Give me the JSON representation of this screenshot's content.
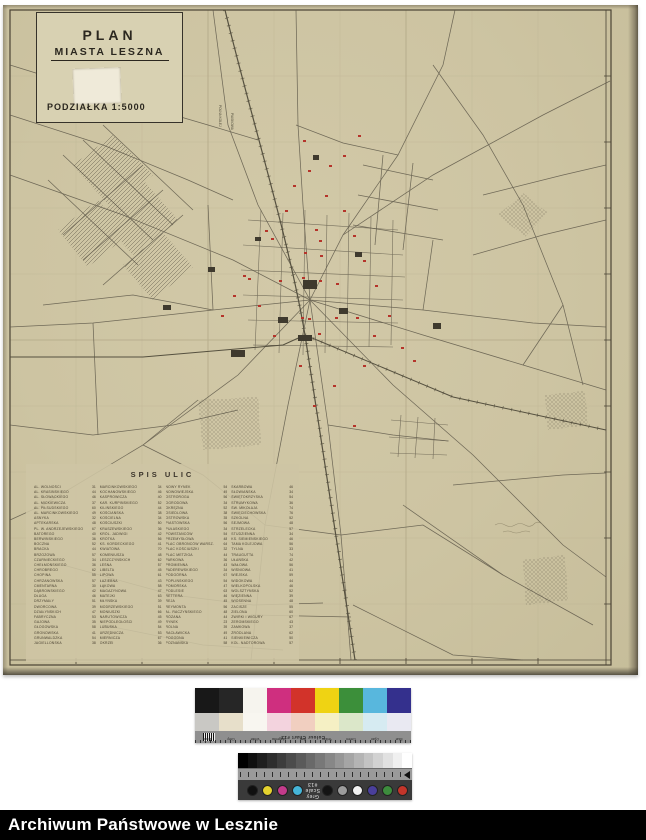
{
  "map_sheet": {
    "title_block": {
      "line1": "PLAN",
      "line2": "MIASTA LESZNA",
      "scale_label": "PODZIAŁKA 1:5000"
    },
    "street_index": {
      "title": "SPIS ULIC",
      "columns": [
        [
          [
            "AL. WOLNOŚCI",
            "31"
          ],
          [
            "AL. KRASIŃSKIEGO",
            "44"
          ],
          [
            "AL. SŁOWACKIEGO",
            "46"
          ],
          [
            "AL. MICKIEWICZA",
            "37"
          ],
          [
            "AL. PIŁSUDSKIEGO",
            "60"
          ],
          [
            "AL. MARCINKOWSKIEGO",
            "49"
          ],
          [
            "ASNYKA",
            "32"
          ],
          [
            "APTEKARSKA",
            "48"
          ],
          [
            "PL. W. ANDRZEJEWSKIEGO",
            "67"
          ],
          [
            "BATOREGO",
            "40"
          ],
          [
            "BERWIŃSKIEGO",
            "36"
          ],
          [
            "BOCZNA",
            "52"
          ],
          [
            "BRACKA",
            "44"
          ],
          [
            "BRZOZOWA",
            "57"
          ],
          [
            "CZARNIECKIEGO",
            "34"
          ],
          [
            "CHEŁMOŃSKIEGO",
            "36"
          ],
          [
            "CHROBREGO",
            "62"
          ],
          [
            "CHOPINA",
            "55"
          ],
          [
            "CHRZANOWSKA",
            "57"
          ],
          [
            "CMENTARNA",
            "30"
          ],
          [
            "DĄBROWSKIEGO",
            "42"
          ],
          [
            "DŁUGA",
            "46"
          ],
          [
            "DRZYMAŁY",
            "51"
          ],
          [
            "DWORCOWA",
            "39"
          ],
          [
            "DZIAŁYŃSKICH",
            "47"
          ],
          [
            "FABRYCZNA",
            "53"
          ],
          [
            "GAJOWA",
            "35"
          ],
          [
            "GŁOGOWSKA",
            "58"
          ],
          [
            "GRONOWSKA",
            "41"
          ],
          [
            "GRUNWALDZKA",
            "54"
          ],
          [
            "JAGIELLOŃSKA",
            "38"
          ]
        ],
        [
          [
            "MARCINKOWSKIEGO",
            "34"
          ],
          [
            "KOCHANOWSKIEGO",
            "46"
          ],
          [
            "KASPROWICZA",
            "40"
          ],
          [
            "KAR. KURPIŃSKIEGO",
            "52"
          ],
          [
            "KILIŃSKIEGO",
            "44"
          ],
          [
            "KOŚCIAŃSKA",
            "38"
          ],
          [
            "KOŚCIELNA",
            "34"
          ],
          [
            "KOŚCIUSZKI",
            "50"
          ],
          [
            "KRASZEWSKIEGO",
            "36"
          ],
          [
            "KRÓL. JADWIGI",
            "42"
          ],
          [
            "KRÓTKA",
            "56"
          ],
          [
            "KS. KORDECKIEGO",
            "41"
          ],
          [
            "KWIATOWA",
            "70"
          ],
          [
            "KOMENIUSZA",
            "48"
          ],
          [
            "LESZCZYŃSKICH",
            "62"
          ],
          [
            "LEŚNA",
            "57"
          ],
          [
            "LIBELTA",
            "45"
          ],
          [
            "LIPOWA",
            "61"
          ],
          [
            "ŁAZIEBNA",
            "43"
          ],
          [
            "ŁĄKOWA",
            "58"
          ],
          [
            "MAGAZYNOWA",
            "47"
          ],
          [
            "MATEJKI",
            "63"
          ],
          [
            "MŁYŃSKA",
            "39"
          ],
          [
            "MODRZEWSKIEGO",
            "51"
          ],
          [
            "MONIUSZKI",
            "66"
          ],
          [
            "NARUTOWICZA",
            "45"
          ],
          [
            "NIEPODLEGŁOŚCI",
            "49"
          ],
          [
            "LUBUSKA",
            "54"
          ],
          [
            "URZĘDNICZA",
            "53"
          ],
          [
            "MIERNICZA",
            "67"
          ],
          [
            "OKRZEI",
            "36"
          ]
        ],
        [
          [
            "NOWY RYNEK",
            "54"
          ],
          [
            "NOWOWIEJSKA",
            "49"
          ],
          [
            "OSTROROGA",
            "56"
          ],
          [
            "OGRODOWA",
            "34"
          ],
          [
            "OKRĘŻNA",
            "52"
          ],
          [
            "OSIEDLOWA",
            "38"
          ],
          [
            "OSTROWSKA",
            "35"
          ],
          [
            "PIASTOWSKA",
            "56"
          ],
          [
            "PUŁASKIEGO",
            "34"
          ],
          [
            "POWSTAŃCÓW",
            "54"
          ],
          [
            "PRZEMYSŁOWA",
            "48"
          ],
          [
            "PLAC OBROŃCÓW WARSZ.",
            "64"
          ],
          [
            "PLAC KOŚCIUSZKI",
            "32"
          ],
          [
            "PLAC METZIGA",
            "44"
          ],
          [
            "PARKOWA",
            "36"
          ],
          [
            "PROMIENNA",
            "43"
          ],
          [
            "PADEREWSKIEGO",
            "34"
          ],
          [
            "PODGÓRNA",
            "67"
          ],
          [
            "POPLIŃSKIEGO",
            "54"
          ],
          [
            "POMORSKA",
            "47"
          ],
          [
            "PODLESIE",
            "63"
          ],
          [
            "RETTERA",
            "46"
          ],
          [
            "REJA",
            "45"
          ],
          [
            "REYMONTA",
            "56"
          ],
          [
            "AL. RACZYŃSKIEGO",
            "48"
          ],
          [
            "RÓŻANA",
            "44"
          ],
          [
            "RYNEK",
            "23"
          ],
          [
            "ROLNA",
            "39"
          ],
          [
            "RACŁAWICKA",
            "49"
          ],
          [
            "POGODNA",
            "41"
          ],
          [
            "POZNAŃSKA",
            "58"
          ]
        ],
        [
          [
            "SKARBOWA",
            "46"
          ],
          [
            "SŁOWIAŃSKA",
            "34"
          ],
          [
            "ŚWIĘTOKRZYSKA",
            "54"
          ],
          [
            "STRUMYKOWA",
            "36"
          ],
          [
            "ŚW. MIKOŁAJA",
            "74"
          ],
          [
            "ŚWIĘCIECHOWSKA",
            "76"
          ],
          [
            "SZKOLNA",
            "52"
          ],
          [
            "SEJMOWA",
            "48"
          ],
          [
            "STRZELECKA",
            "57"
          ],
          [
            "STUDZIENNA",
            "34"
          ],
          [
            "KS. SIEMIEŃSKIEGO",
            "46"
          ],
          [
            "TAMA KOLEJOWA",
            "56"
          ],
          [
            "TYLNA",
            "33"
          ],
          [
            "TRAUGUTTA",
            "74"
          ],
          [
            "UŁAŃSKA",
            "42"
          ],
          [
            "WAŁOWA",
            "56"
          ],
          [
            "WIŚNIOWA",
            "41"
          ],
          [
            "WIEJSKA",
            "59"
          ],
          [
            "WIDOKOWA",
            "44"
          ],
          [
            "WIELKOPOLSKA",
            "46"
          ],
          [
            "WOLSZTYŃSKA",
            "52"
          ],
          [
            "WIĘZIENNA",
            "39"
          ],
          [
            "WIOSENNA",
            "48"
          ],
          [
            "ZACISZE",
            "55"
          ],
          [
            "ZIELONA",
            "60"
          ],
          [
            "ŻWIRKI I WIGURY",
            "67"
          ],
          [
            "ŻEROMSKIEGO",
            "43"
          ],
          [
            "ZAMKOWA",
            "37"
          ],
          [
            "ŹRÓDLANA",
            "62"
          ],
          [
            "SIENKIEWICZA",
            "50"
          ],
          [
            "KOL. NADTOROWA",
            "57"
          ]
        ]
      ]
    },
    "road_labels": [
      "POLNA KOLEJ",
      "PIASKOWA"
    ],
    "colors": {
      "paper": "#cdc4a2",
      "ink": "#5f594a",
      "frame": "#4a4334",
      "red_marker": "#b5342a",
      "building": "#3f3a2e"
    }
  },
  "calibration": {
    "colour_chart": {
      "title": "Colour Chart #13",
      "labels": [
        "Black",
        "Grey",
        "White",
        "Magenta",
        "Red",
        "Yellow",
        "Green",
        "Cyan",
        "Blue"
      ],
      "colors": [
        "#181818",
        "#262626",
        "#f6f4ee",
        "#cf2f7f",
        "#d2332a",
        "#efd313",
        "#3c8f3a",
        "#58b7dd",
        "#34308d"
      ],
      "tints": [
        "#c9c8c4",
        "#e7dfca",
        "#f8f6f0",
        "#f3d3de",
        "#f1cfc0",
        "#f5f0c4",
        "#dbe7c9",
        "#d6ebf2",
        "#e9e9f2"
      ]
    },
    "grey_scale": {
      "title": "Grey Scale #13",
      "steps": 18,
      "left_dots": [
        "#101010",
        "#e4d22e",
        "#c43b8b",
        "#45b5d8"
      ],
      "mid_dots": [
        "#141414",
        "#9c9c9c",
        "#f2f2f2"
      ],
      "right_dots": [
        "#4a3f9b",
        "#3d8c3d",
        "#c3352a"
      ]
    }
  },
  "footer": {
    "label": "Archiwum Państwowe w Lesznie"
  }
}
